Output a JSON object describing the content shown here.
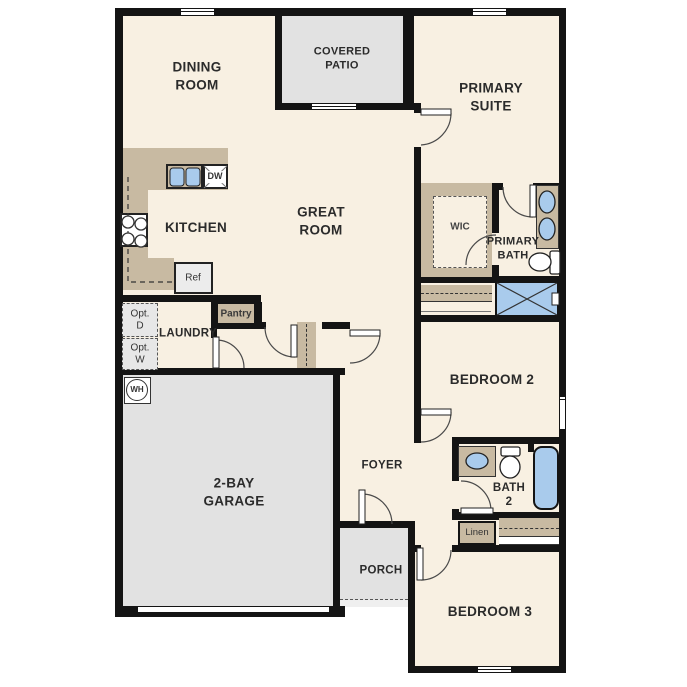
{
  "title": "Single-story home floor plan",
  "labels": {
    "dining": "DINING\nROOM",
    "patio": "COVERED\nPATIO",
    "primary_suite": "PRIMARY\nSUITE",
    "kitchen": "KITCHEN",
    "great_room": "GREAT\nROOM",
    "wic": "WIC",
    "primary_bath": "PRIMARY\nBATH",
    "laundry": "LAUNDRY",
    "pantry": "Pantry",
    "ref": "Ref",
    "dw": "DW",
    "opt_d": "Opt.\nD",
    "opt_w": "Opt.\nW",
    "wh": "WH",
    "garage": "2-BAY\nGARAGE",
    "foyer": "FOYER",
    "bedroom2": "BEDROOM 2",
    "bath2": "BATH\n2",
    "linen": "Linen",
    "porch": "PORCH",
    "bedroom3": "BEDROOM 3"
  },
  "colors": {
    "floor": "#f8f0e2",
    "wall": "#141414",
    "cabinet_tan": "#c8baa2",
    "fixture_blue": "#a9cbec",
    "concrete_gray": "#e2e2e2",
    "text": "#2b2b2b"
  }
}
